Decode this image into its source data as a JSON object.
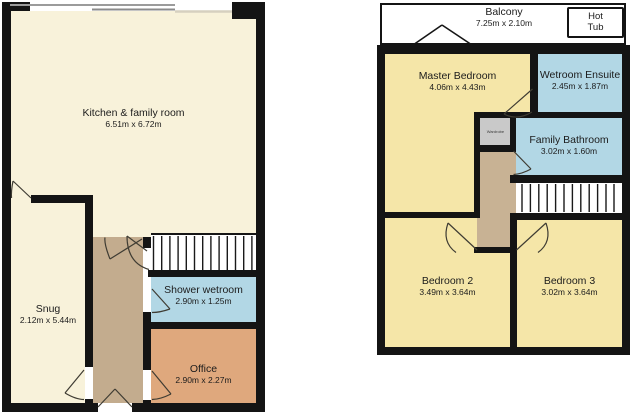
{
  "palette": {
    "wall": "#141414",
    "cream": "#f8f2da",
    "yellow": "#f5e6a8",
    "blue": "#b2d7e5",
    "orange": "#dfa87d",
    "tan": "#c3ac8e",
    "tan2": "#c8b294",
    "gray": "#c9c9c9",
    "doorline": "#3f3c33",
    "text": "#1c1c1c",
    "bg": "#ffffff"
  },
  "ground_floor": {
    "kitchen": {
      "name": "Kitchen & family room",
      "dims": "6.51m x 6.72m"
    },
    "snug": {
      "name": "Snug",
      "dims": "2.12m x 5.44m"
    },
    "shower_wetroom": {
      "name": "Shower wetroom",
      "dims": "2.90m x 1.25m"
    },
    "office": {
      "name": "Office",
      "dims": "2.90m x 2.27m"
    }
  },
  "first_floor": {
    "balcony": {
      "name": "Balcony",
      "dims": "7.25m x 2.10m"
    },
    "hot_tub": {
      "line1": "Hot",
      "line2": "Tub"
    },
    "master_bedroom": {
      "name": "Master Bedroom",
      "dims": "4.06m x 4.43m"
    },
    "wetroom_ensuite": {
      "name": "Wetroom Ensuite",
      "dims": "2.45m x 1.87m"
    },
    "family_bathroom": {
      "name": "Family Bathroom",
      "dims": "3.02m x 1.60m"
    },
    "bedroom_2": {
      "name": "Bedroom 2",
      "dims": "3.49m x 3.64m"
    },
    "bedroom_3": {
      "name": "Bedroom 3",
      "dims": "3.02m x 3.64m"
    },
    "wardrobe": {
      "name": "Wardrobe"
    }
  }
}
